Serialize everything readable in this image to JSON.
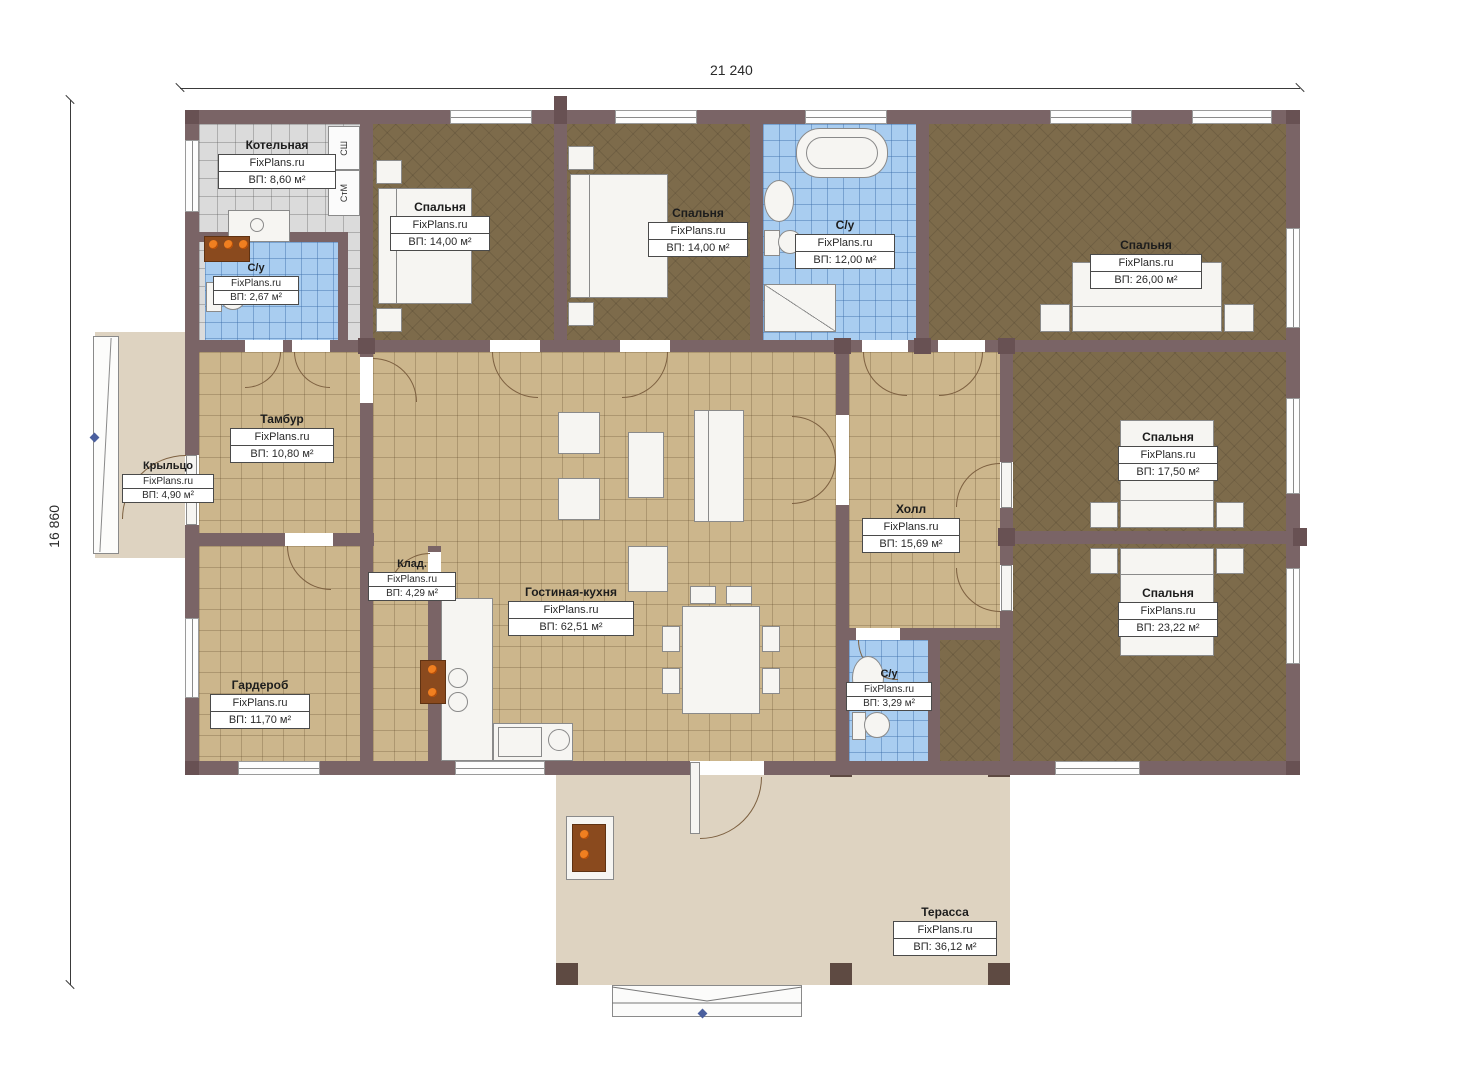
{
  "meta": {
    "watermark": "FixPlans.ru",
    "plan_type": "floor-plan"
  },
  "dimensions": {
    "width_label": "21 240",
    "height_label": "16 860"
  },
  "appliances": {
    "dryer": "СШ",
    "washer": "СтМ"
  },
  "rooms": [
    {
      "id": "boiler",
      "name": "Котельная",
      "area": "ВП: 8,60 м²"
    },
    {
      "id": "wc1",
      "name": "С/у",
      "area": "ВП: 2,67 м²"
    },
    {
      "id": "bedroom1",
      "name": "Спальня",
      "area": "ВП: 14,00 м²"
    },
    {
      "id": "bedroom2",
      "name": "Спальня",
      "area": "ВП: 14,00 м²"
    },
    {
      "id": "wc2",
      "name": "С/у",
      "area": "ВП: 12,00 м²"
    },
    {
      "id": "bedroom3",
      "name": "Спальня",
      "area": "ВП: 26,00 м²"
    },
    {
      "id": "porch",
      "name": "Крыльцо",
      "area": "ВП: 4,90 м²"
    },
    {
      "id": "tambour",
      "name": "Тамбур",
      "area": "ВП: 10,80 м²"
    },
    {
      "id": "living",
      "name": "Гостиная-кухня",
      "area": "ВП: 62,51 м²"
    },
    {
      "id": "hall",
      "name": "Холл",
      "area": "ВП: 15,69 м²"
    },
    {
      "id": "bedroom4",
      "name": "Спальня",
      "area": "ВП: 17,50 м²"
    },
    {
      "id": "wardrobe",
      "name": "Гардероб",
      "area": "ВП: 11,70 м²"
    },
    {
      "id": "storage",
      "name": "Клад.",
      "area": "ВП: 4,29 м²"
    },
    {
      "id": "wc3",
      "name": "С/у",
      "area": "ВП: 3,29 м²"
    },
    {
      "id": "bedroom5",
      "name": "Спальня",
      "area": "ВП: 23,22 м²"
    },
    {
      "id": "terrace",
      "name": "Терасса",
      "area": "ВП: 36,12 м²"
    }
  ],
  "colors": {
    "wall": "#7a6466",
    "floor_tan": "#ccb68c",
    "floor_brown": "#7d6b4b",
    "floor_blue": "#a9cdf0",
    "floor_gray": "#dbdbdb",
    "terrace": "#ded3c1",
    "accent_orange": "#f07f20"
  }
}
